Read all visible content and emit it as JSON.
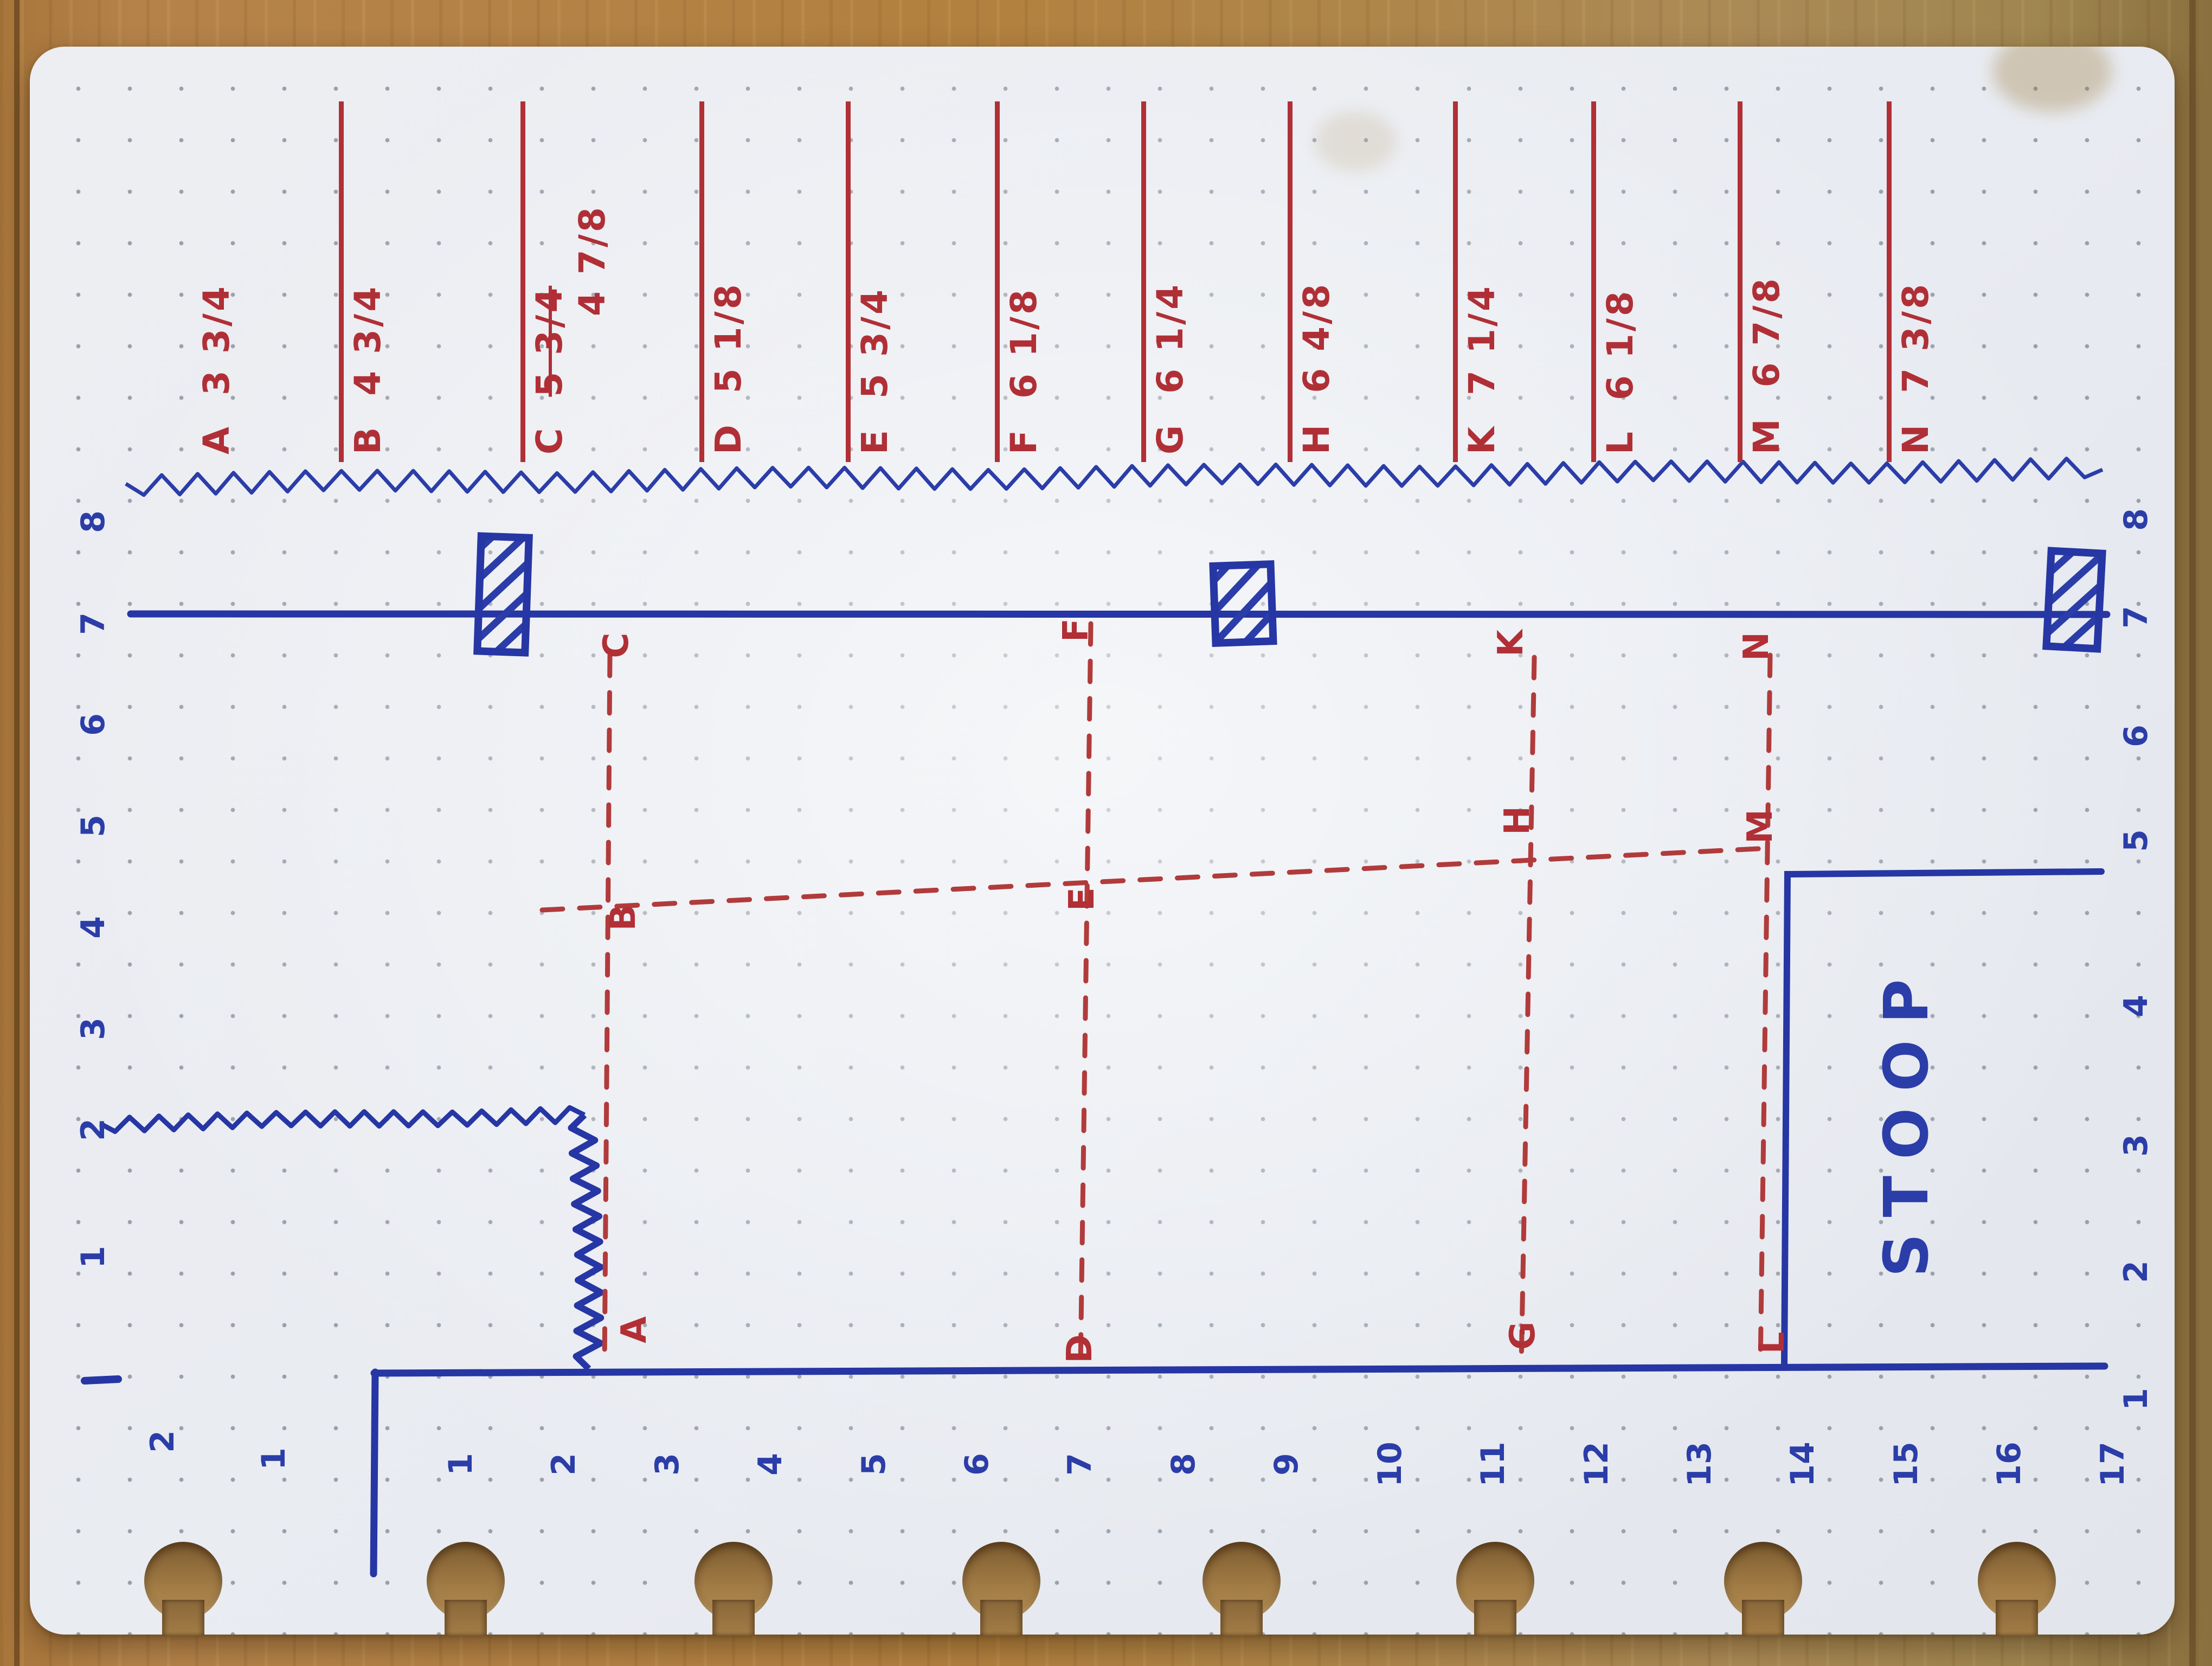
{
  "sheet": {
    "description": "hand-drawn porch/deck measurement sketch on dot-grid disc-bound notebook page, photographed on a wooden table",
    "stoop_label": "STOOP"
  },
  "measurements": [
    {
      "label": "A",
      "value": "3 3/4"
    },
    {
      "label": "B",
      "value": "4 3/4"
    },
    {
      "label": "C",
      "value": "5 3/4",
      "struck": true,
      "correction": "4 7/8"
    },
    {
      "label": "D",
      "value": "5 1/8"
    },
    {
      "label": "E",
      "value": "5 3/4"
    },
    {
      "label": "F",
      "value": "6 1/8"
    },
    {
      "label": "G",
      "value": "6 1/4"
    },
    {
      "label": "H",
      "value": "6 4/8"
    },
    {
      "label": "K",
      "value": "7 1/4"
    },
    {
      "label": "L",
      "value": "6 1/8"
    },
    {
      "label": "M",
      "value": "6 7/8"
    },
    {
      "label": "N",
      "value": "7 3/8"
    }
  ],
  "point_labels": {
    "top": [
      "C",
      "F",
      "K",
      "N"
    ],
    "middle": [
      "B",
      "E",
      "H",
      "M"
    ],
    "bottom": [
      "A",
      "D",
      "G",
      "L"
    ]
  },
  "scales": {
    "left": [
      "8",
      "7",
      "6",
      "5",
      "4",
      "3",
      "2",
      "1"
    ],
    "right": [
      "8",
      "7",
      "6",
      "5",
      "4",
      "3",
      "2",
      "1"
    ],
    "bottom": [
      "1",
      "2",
      "3",
      "4",
      "5",
      "6",
      "7",
      "8",
      "9",
      "10",
      "11",
      "12",
      "13",
      "14",
      "15",
      "16",
      "17"
    ],
    "bottom_left_extra": [
      "2",
      "1"
    ]
  },
  "colors": {
    "ink_blue": "#2b3da8",
    "ink_red": "#b02f36",
    "paper": "#e9ecf1",
    "wood": "#b2813f",
    "grid_dot": "#99a0ab"
  }
}
